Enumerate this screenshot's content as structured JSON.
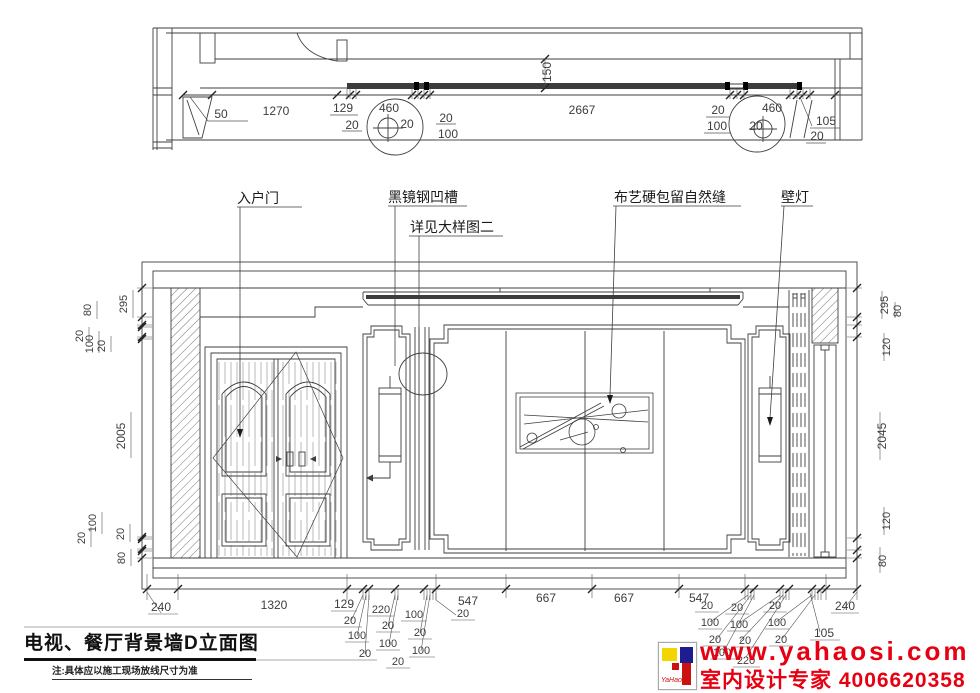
{
  "labels": {
    "entry_door": "入户门",
    "black_mirror_groove": "黑镜钢凹槽",
    "see_detail": "详见大样图二",
    "fabric_panel": "布艺硬包留自然缝",
    "wall_lamp": "壁灯"
  },
  "plan": {
    "dims": {
      "d50": "50",
      "d1270": "1270",
      "d129": "129",
      "d20a": "20",
      "d460L": "460",
      "d20circleL": "20",
      "d20b": "20",
      "d100b": "100",
      "d2667": "2667",
      "d20c": "20",
      "d100c": "100",
      "d460R": "460",
      "d20circleR": "20",
      "d105": "105",
      "d20d": "20",
      "d150": "150"
    }
  },
  "elevation": {
    "left_dims": [
      "295",
      "80",
      "20",
      "100",
      "20",
      "2005",
      "100",
      "20",
      "20",
      "80"
    ],
    "right_dims": [
      "295",
      "80",
      "120",
      "2045",
      "120",
      "80"
    ],
    "bottom_main": [
      "240",
      "1320",
      "129",
      "547",
      "667",
      "667",
      "547",
      "105",
      "240"
    ],
    "bottom_left_cluster": [
      "20",
      "100",
      "20",
      "220",
      "20",
      "100",
      "20",
      "100",
      "20",
      "100",
      "20"
    ],
    "bottom_right_cluster": [
      "20",
      "100",
      "20",
      "100",
      "220",
      "20",
      "100",
      "20",
      "20",
      "100",
      "20"
    ]
  },
  "title": {
    "text": "电视、餐厅背景墙D立面图",
    "note": "注:具体应以施工现场放线尺寸为准"
  },
  "branding": {
    "url": "www.yahaosi.com",
    "tagline": "室内设计专家",
    "phone": "4006620358",
    "logo_text": "YaHaosi",
    "accent_red": "#e60012",
    "logo_yellow": "#f5d500",
    "logo_blue": "#1d1d8f",
    "logo_red": "#cc1111"
  }
}
